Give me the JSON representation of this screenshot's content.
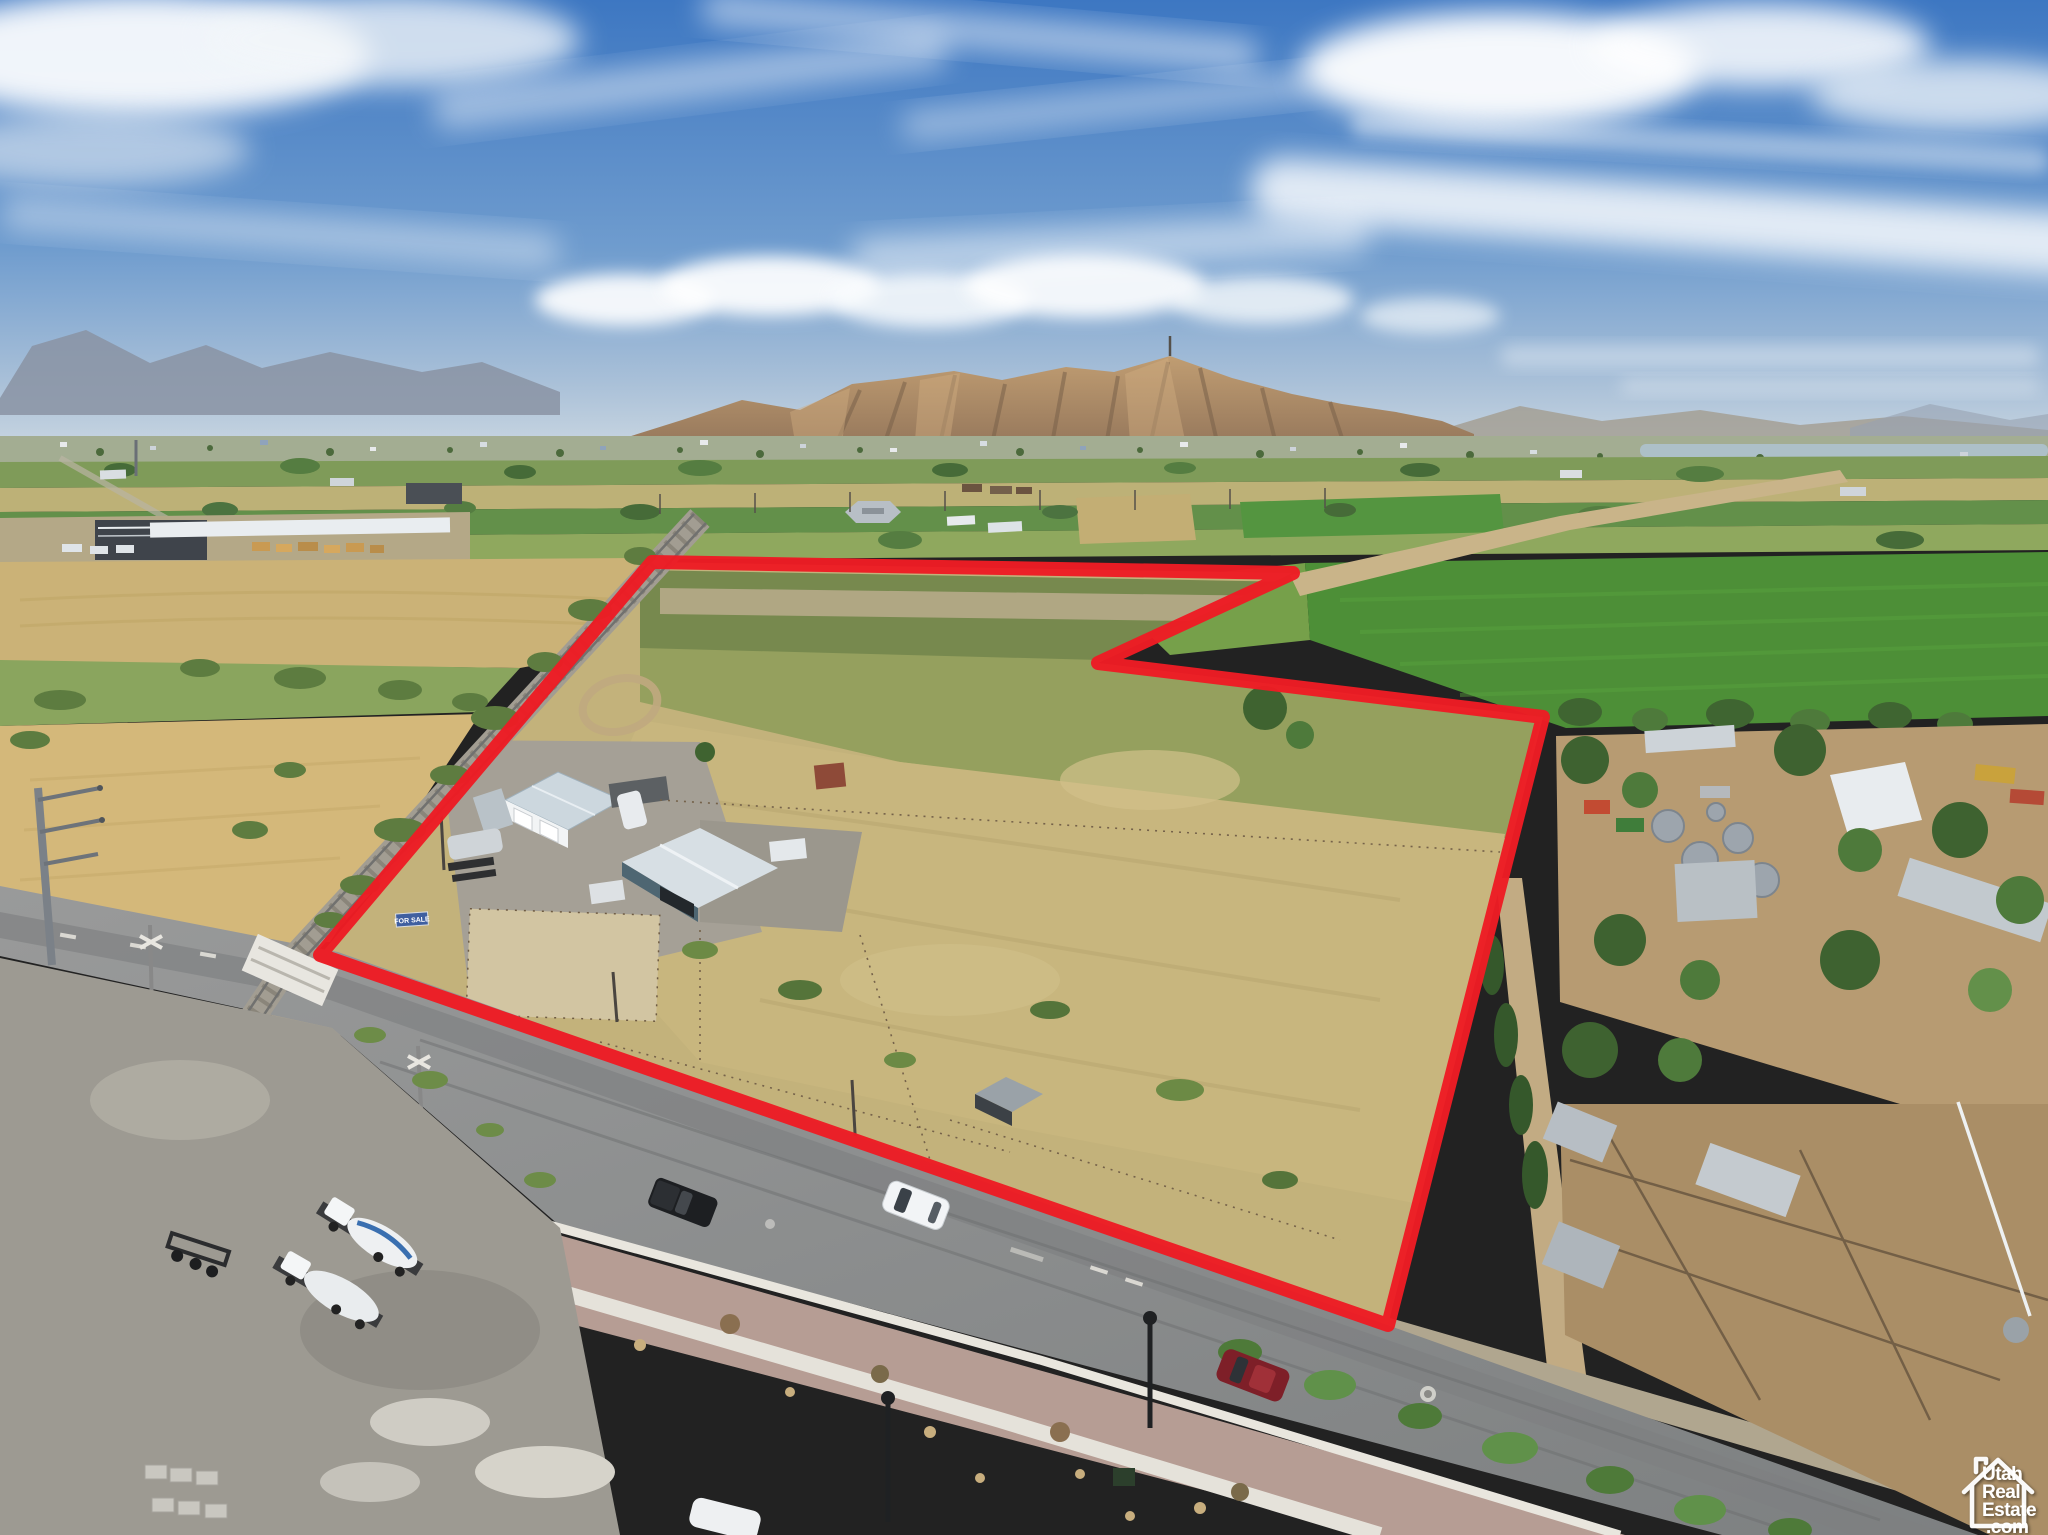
{
  "page": {
    "title": "Aerial drone photo of rural parcel outlined in red"
  },
  "watermark": {
    "name": "UtahRealEstate.com",
    "icon": "house-outline-icon",
    "lines": [
      "Utah",
      "Real",
      "Estate",
      ".com"
    ],
    "color": "#ffffff"
  },
  "boundary": {
    "shape": "closed-polygon",
    "points": "652,562 1293,573 1098,663 1543,717 1388,1325 320,955",
    "color": "#ED1C24",
    "stroke_width": 14
  },
  "signs": {
    "for_sale": {
      "text": "FOR SALE",
      "bg_color": "#3f5fa0",
      "text_color": "#ffffff"
    }
  },
  "scene": {
    "setting": "rural Utah valley, summer, midday drone view",
    "sky": {
      "top_color": "#3d77c2",
      "horizon_color": "#c9d6e1",
      "clouds": "white cirrus bands and cumulus row above mountains"
    },
    "mountains": {
      "main_color": "#b2906a",
      "shadow_color": "#79614a",
      "far_left_color": "#8a93a3",
      "antenna_on_peak": true
    },
    "water_strip_color": "#aec2ce",
    "fields": [
      "bright green alfalfa",
      "olive pasture",
      "tan wheat stubble",
      "dry golden grass inside parcel"
    ],
    "roads": {
      "paved_color": "#8f9091",
      "dirt_color": "#c9b489"
    },
    "vehicles": [
      {
        "kind": "white SUV on road"
      },
      {
        "kind": "black pickup parked on shoulder"
      },
      {
        "kind": "maroon SUV on road"
      },
      {
        "kind": "two white cement-mixer trucks in gravel yard"
      }
    ],
    "features": [
      "large white-roof warehouse at left",
      "railroad crossing with white panels",
      "metal shop buildings and trailers inside parcel",
      "neighboring farmstead with grain bins and corrals",
      "landscaped parkstrip with young trees and street lamps",
      "small pond at far right",
      "dirt farm lane along parcel top edge"
    ]
  }
}
